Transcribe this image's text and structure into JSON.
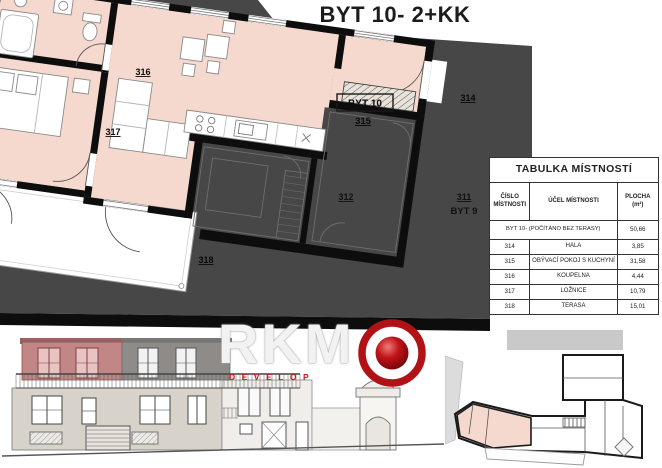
{
  "title": "BYT 10- 2+KK",
  "plan": {
    "labels": {
      "bathroom": "316",
      "bedroom": "317",
      "living_apartment": "BYT 10",
      "living": "315",
      "hall": "314",
      "terrace": "318",
      "neighbor_room": "312",
      "neighbor_hall": "311",
      "neighbor_apartment": "BYT 9"
    }
  },
  "room_table": {
    "title": "TABULKA MÍSTNOSTÍ",
    "columns": {
      "number_line1": "ČÍSLO",
      "number_line2": "MÍSTNOSTI",
      "purpose": "ÚČEL MÍSTNOSTI",
      "area_line1": "PLOCHA",
      "area_line2": "(m²)"
    },
    "summary_row": {
      "label": "BYT 10- (POČÍTÁNO BEZ TERASY)",
      "area": "50,66"
    },
    "rows": [
      {
        "number": "314",
        "purpose": "HALA",
        "area": "3,85"
      },
      {
        "number": "315",
        "purpose": "OBÝVACÍ POKOJ S KUCHYNÍ",
        "area": "31,58"
      },
      {
        "number": "316",
        "purpose": "KOUPELNA",
        "area": "4,44"
      },
      {
        "number": "317",
        "purpose": "LOŽNICE",
        "area": "10,79"
      },
      {
        "number": "318",
        "purpose": "TERASA",
        "area": "15,01"
      }
    ]
  },
  "logo": {
    "text": "RKM",
    "subtitle": "DEVELOP"
  },
  "colors": {
    "highlight_pink": "#f6d9ce",
    "background_gray": "#474747",
    "logo_red": "#b11216",
    "elevation_red": "#c28686"
  }
}
